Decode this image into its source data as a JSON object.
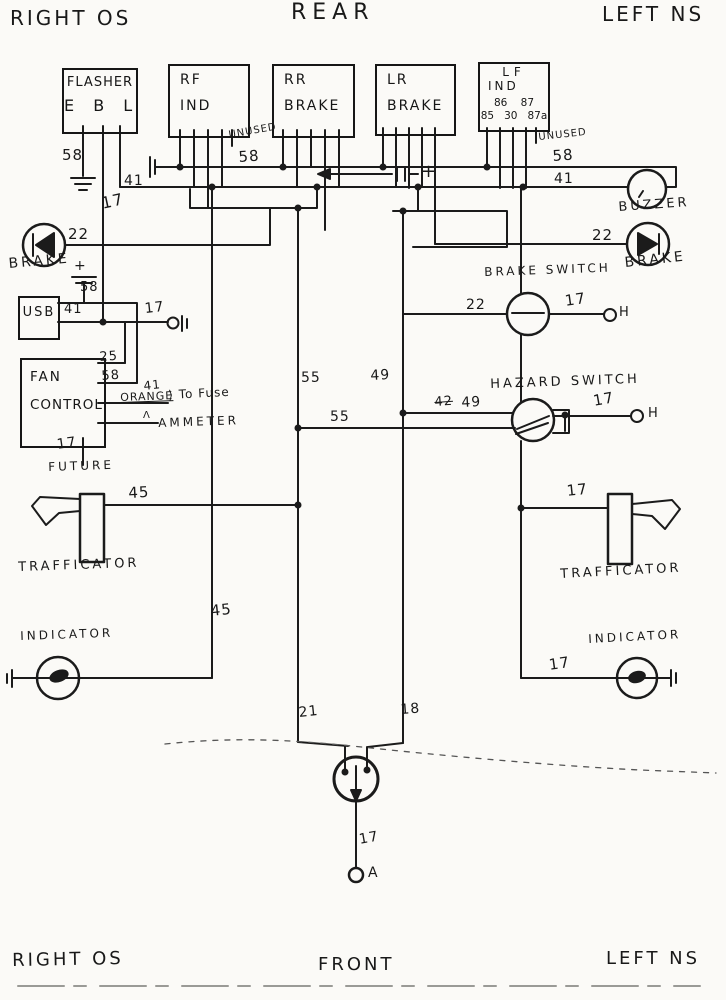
{
  "canvas": {
    "paper_color": "#fbfaf7",
    "ink_color": "#1b1b1b"
  },
  "boxes": {
    "flasher": {
      "line1": "FLASHER",
      "line2": "E B L"
    },
    "rf_ind": {
      "line1": "RF",
      "line2": "IND"
    },
    "rr_brake": {
      "line1": "RR",
      "line2": "BRAKE"
    },
    "lr_brake": {
      "line1": "LR",
      "line2": "BRAKE"
    },
    "lf_ind": {
      "line1": "LF",
      "line2": "IND",
      "relay_top": "86    87",
      "relay_bottom": "85   30   87a"
    },
    "usb": {
      "line1": "USB"
    },
    "fan_control": {
      "line1": "FAN",
      "line2": "CONTROL"
    }
  },
  "wire_labels": [
    {
      "name": "corner-top-left",
      "text": "RIGHT OS",
      "x": 10,
      "y": 8,
      "size": 20,
      "rot": 0,
      "cls": "sp"
    },
    {
      "name": "corner-top-center",
      "text": "REAR",
      "x": 291,
      "y": 2,
      "size": 22,
      "rot": 0,
      "cls": "sp2"
    },
    {
      "name": "corner-top-right",
      "text": "LEFT NS",
      "x": 602,
      "y": 4,
      "size": 20,
      "rot": 0,
      "cls": "sp"
    },
    {
      "name": "corner-bottom-left",
      "text": "RIGHT OS",
      "x": 12,
      "y": 952,
      "size": 18,
      "rot": -1,
      "cls": "sp"
    },
    {
      "name": "corner-bottom-center",
      "text": "FRONT",
      "x": 318,
      "y": 956,
      "size": 18,
      "rot": 0,
      "cls": "sp"
    },
    {
      "name": "corner-bottom-right",
      "text": "LEFT NS",
      "x": 606,
      "y": 950,
      "size": 18,
      "rot": 0,
      "cls": "sp"
    },
    {
      "name": "wire-58-flasher",
      "text": "58",
      "x": 62,
      "y": 148,
      "size": 15,
      "rot": 0
    },
    {
      "name": "wire-17-left",
      "text": "17",
      "x": 100,
      "y": 196,
      "size": 16,
      "rot": -12
    },
    {
      "name": "wire-41-left",
      "text": "41",
      "x": 124,
      "y": 174,
      "size": 14,
      "rot": 0
    },
    {
      "name": "wire-58-bus",
      "text": "58",
      "x": 238,
      "y": 150,
      "size": 15,
      "rot": -4
    },
    {
      "name": "unused-rf",
      "text": "UNUSED",
      "x": 228,
      "y": 131,
      "size": 10,
      "rot": -10
    },
    {
      "name": "wire-58-right",
      "text": "58",
      "x": 552,
      "y": 149,
      "size": 15,
      "rot": -4
    },
    {
      "name": "wire-41-right",
      "text": "41",
      "x": 554,
      "y": 172,
      "size": 14,
      "rot": 0
    },
    {
      "name": "plus-feed",
      "text": "+",
      "x": 421,
      "y": 163,
      "size": 18,
      "rot": 0
    },
    {
      "name": "unused-lf",
      "text": "UNUSED",
      "x": 538,
      "y": 133,
      "size": 10,
      "rot": -6
    },
    {
      "name": "buzzer-label",
      "text": "BUZZER",
      "x": 618,
      "y": 201,
      "size": 13,
      "rot": -4,
      "cls": "sp"
    },
    {
      "name": "wire-22-left",
      "text": "22",
      "x": 68,
      "y": 227,
      "size": 15,
      "rot": 0
    },
    {
      "name": "brake-left-label",
      "text": "BRAKE",
      "x": 8,
      "y": 257,
      "size": 14,
      "rot": -5,
      "cls": "sp"
    },
    {
      "name": "wire-22-right",
      "text": "22",
      "x": 592,
      "y": 228,
      "size": 15,
      "rot": 0
    },
    {
      "name": "brake-right-label",
      "text": "BRAKE",
      "x": 624,
      "y": 256,
      "size": 14,
      "rot": -6,
      "cls": "sp"
    },
    {
      "name": "plus-usb",
      "text": "+",
      "x": 74,
      "y": 259,
      "size": 14,
      "rot": 0
    },
    {
      "name": "wire-58-usb",
      "text": "58",
      "x": 80,
      "y": 281,
      "size": 13,
      "rot": 0
    },
    {
      "name": "wire-41-usb",
      "text": "41",
      "x": 64,
      "y": 303,
      "size": 13,
      "rot": 0
    },
    {
      "name": "wire-17-usb",
      "text": "17",
      "x": 144,
      "y": 302,
      "size": 14,
      "rot": -6
    },
    {
      "name": "wire-25-fan",
      "text": "25",
      "x": 99,
      "y": 351,
      "size": 13,
      "rot": -4
    },
    {
      "name": "wire-58-fan",
      "text": "58",
      "x": 101,
      "y": 370,
      "size": 13,
      "rot": -4
    },
    {
      "name": "wire-41-fan",
      "text": "41",
      "x": 143,
      "y": 380,
      "size": 12,
      "rot": -6
    },
    {
      "name": "orange-label",
      "text": "ORANGE",
      "x": 120,
      "y": 392,
      "size": 11,
      "rot": -2,
      "cls": "underline"
    },
    {
      "name": "to-fuse-label",
      "text": "⟩ To Fuse",
      "x": 168,
      "y": 389,
      "size": 12,
      "rot": -3
    },
    {
      "name": "ammeter-arrow",
      "text": "Λ",
      "x": 143,
      "y": 411,
      "size": 10,
      "rot": 0
    },
    {
      "name": "ammeter-label",
      "text": "AMMETER",
      "x": 158,
      "y": 417,
      "size": 12,
      "rot": -2,
      "cls": "sp"
    },
    {
      "name": "wire-17-fan",
      "text": "17",
      "x": 56,
      "y": 438,
      "size": 14,
      "rot": -8
    },
    {
      "name": "future-label",
      "text": "FUTURE",
      "x": 48,
      "y": 461,
      "size": 12,
      "rot": -2,
      "cls": "sp"
    },
    {
      "name": "brake-switch-label",
      "text": "BRAKE SWITCH",
      "x": 484,
      "y": 266,
      "size": 12,
      "rot": -2,
      "cls": "sp"
    },
    {
      "name": "wire-22-brake-switch",
      "text": "22",
      "x": 466,
      "y": 298,
      "size": 14,
      "rot": 0
    },
    {
      "name": "wire-17-brake-switch",
      "text": "17",
      "x": 564,
      "y": 294,
      "size": 15,
      "rot": -8
    },
    {
      "name": "terminal-h-brake",
      "text": "H",
      "x": 619,
      "y": 306,
      "size": 13,
      "rot": 0
    },
    {
      "name": "hazard-switch-label",
      "text": "HAZARD SWITCH",
      "x": 490,
      "y": 378,
      "size": 13,
      "rot": -2,
      "cls": "sp"
    },
    {
      "name": "wire-42-strike",
      "text": "42",
      "x": 434,
      "y": 396,
      "size": 13,
      "rot": -4,
      "cls": "strike"
    },
    {
      "name": "wire-49-hazard",
      "text": "49",
      "x": 461,
      "y": 396,
      "size": 14,
      "rot": -3
    },
    {
      "name": "wire-17-hazard",
      "text": "17",
      "x": 592,
      "y": 394,
      "size": 15,
      "rot": -10
    },
    {
      "name": "terminal-h-hazard",
      "text": "H",
      "x": 648,
      "y": 407,
      "size": 13,
      "rot": 0
    },
    {
      "name": "wire-55-vertical",
      "text": "55",
      "x": 301,
      "y": 371,
      "size": 14,
      "rot": 0
    },
    {
      "name": "wire-49-vertical",
      "text": "49",
      "x": 370,
      "y": 369,
      "size": 14,
      "rot": -3
    },
    {
      "name": "wire-55-horizontal",
      "text": "55",
      "x": 330,
      "y": 410,
      "size": 14,
      "rot": 0
    },
    {
      "name": "wire-45-trafficator",
      "text": "45",
      "x": 128,
      "y": 486,
      "size": 15,
      "rot": -3
    },
    {
      "name": "wire-17-trafficator",
      "text": "17",
      "x": 566,
      "y": 484,
      "size": 15,
      "rot": -6
    },
    {
      "name": "trafficator-left-label",
      "text": "TRAFFICATOR",
      "x": 18,
      "y": 561,
      "size": 13,
      "rot": -2,
      "cls": "sp"
    },
    {
      "name": "trafficator-right-label",
      "text": "TRAFFICATOR",
      "x": 560,
      "y": 568,
      "size": 13,
      "rot": -3,
      "cls": "sp"
    },
    {
      "name": "wire-45-indicator",
      "text": "45",
      "x": 210,
      "y": 604,
      "size": 15,
      "rot": -6
    },
    {
      "name": "indicator-left-label",
      "text": "INDICATOR",
      "x": 20,
      "y": 630,
      "size": 12,
      "rot": -2,
      "cls": "sp"
    },
    {
      "name": "indicator-right-label",
      "text": "INDICATOR",
      "x": 588,
      "y": 633,
      "size": 12,
      "rot": -3,
      "cls": "sp"
    },
    {
      "name": "wire-17-indicator",
      "text": "17",
      "x": 548,
      "y": 658,
      "size": 15,
      "rot": -8
    },
    {
      "name": "wire-21-plug",
      "text": "21",
      "x": 298,
      "y": 706,
      "size": 14,
      "rot": -6
    },
    {
      "name": "wire-18-plug",
      "text": "18",
      "x": 400,
      "y": 703,
      "size": 14,
      "rot": -4
    },
    {
      "name": "wire-17-plug",
      "text": "17",
      "x": 358,
      "y": 833,
      "size": 14,
      "rot": -10
    },
    {
      "name": "terminal-a",
      "text": "A",
      "x": 368,
      "y": 866,
      "size": 14,
      "rot": 0
    }
  ]
}
